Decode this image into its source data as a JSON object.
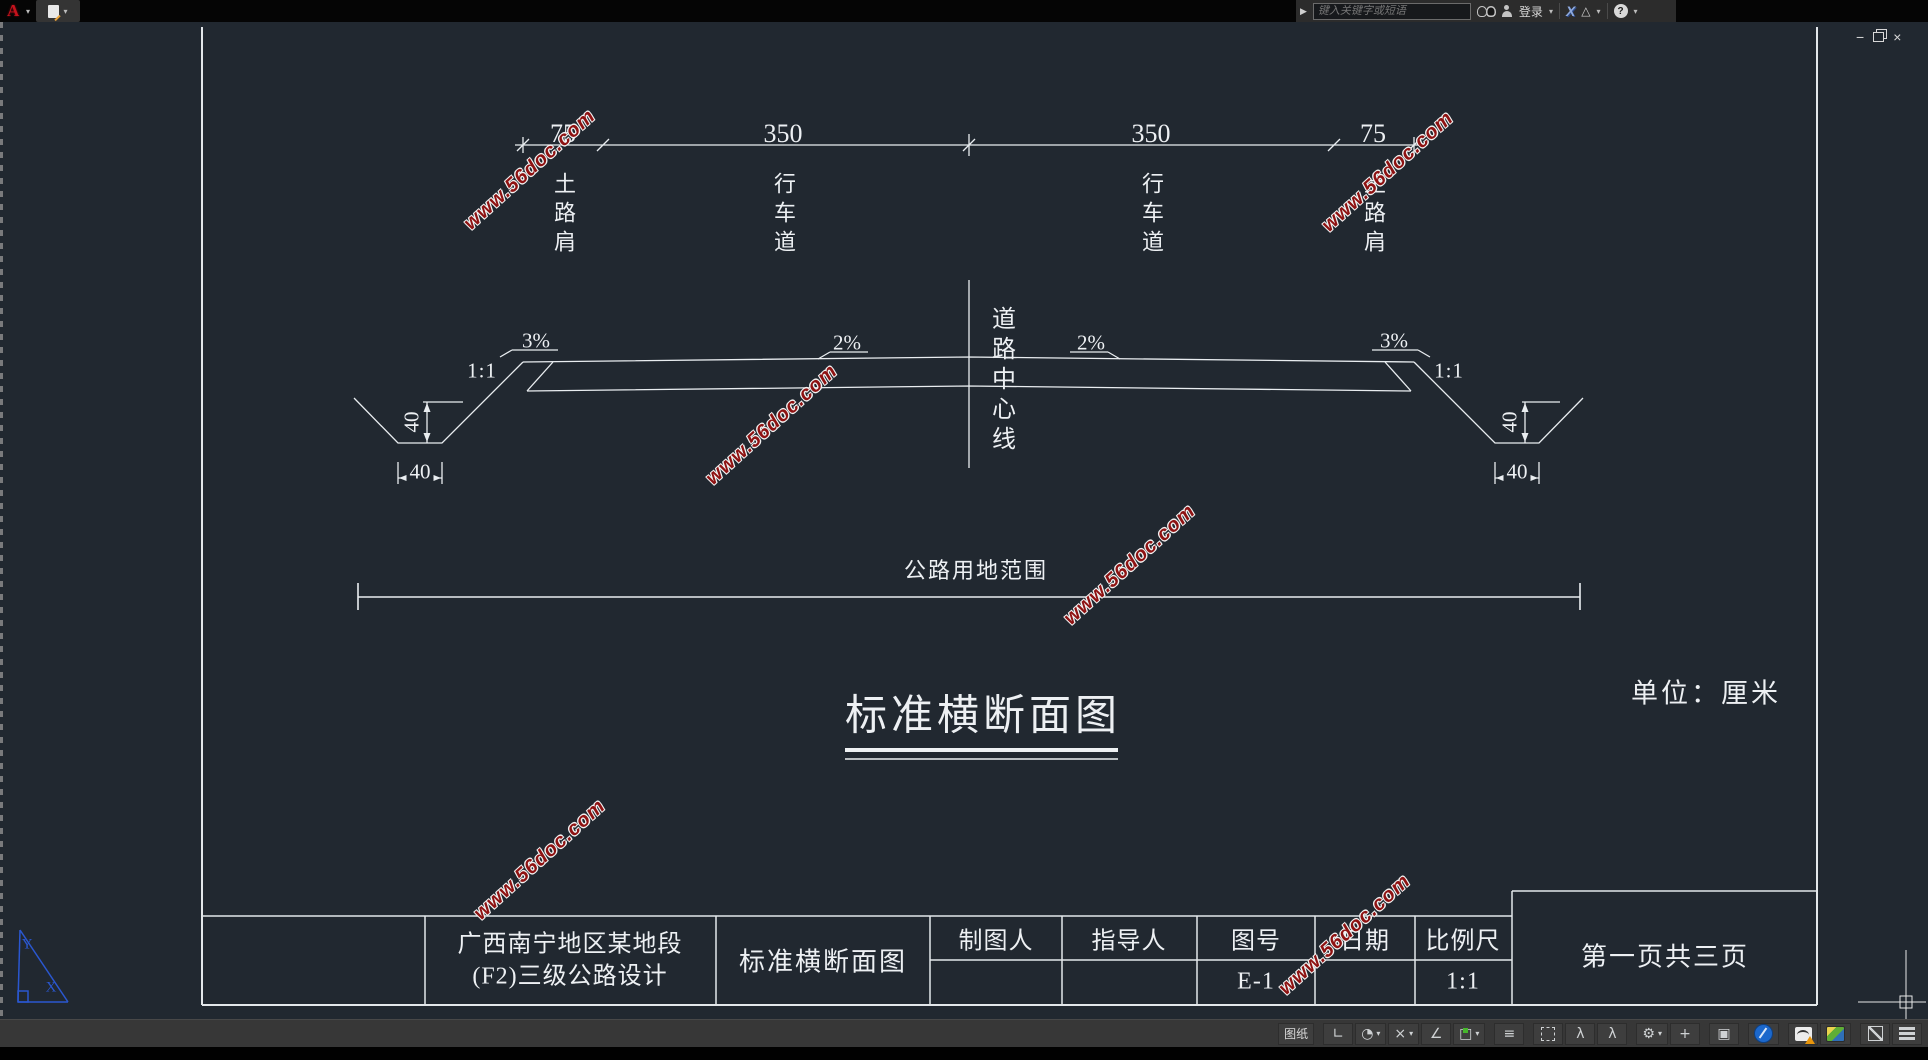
{
  "ui": {
    "dropdown_arrow": "▾"
  },
  "titlebar": {
    "logo": "A",
    "prompt_arrow": "▶",
    "search_placeholder": "键入关键字或短语",
    "signin_label": "登录",
    "exchange_glyph": "X",
    "a360_glyph": "△",
    "help_glyph": "?"
  },
  "doc_window": {
    "minimize": "−",
    "close": "×"
  },
  "drawing": {
    "dim_top": {
      "seg1": "75",
      "seg2": "350",
      "seg3": "350",
      "seg4": "75"
    },
    "lanes": {
      "left_shoulder": "土路肩",
      "left_lane": "行车道",
      "right_lane": "行车道",
      "right_shoulder": "土路肩"
    },
    "centerline_label": "道路中心线",
    "slopes": {
      "left_outer": "3%",
      "left_inner": "2%",
      "right_inner": "2%",
      "right_outer": "3%",
      "left_ratio": "1:1",
      "right_ratio": "1:1"
    },
    "ditch": {
      "left_depth": "40",
      "left_width": "40",
      "right_depth": "40",
      "right_width": "40"
    },
    "extent_label": "公路用地范围",
    "main_title": "标准横断面图",
    "unit_note": "单位：厘米",
    "ucs": {
      "x": "X",
      "y": "Y"
    }
  },
  "title_block": {
    "project_line1": "广西南宁地区某地段",
    "project_line2": "(F2)三级公路设计",
    "drawing_name": "标准横断面图",
    "drafter_label": "制图人",
    "advisor_label": "指导人",
    "sheet_label": "图号",
    "sheet_no": "E-1",
    "date_label": "日期",
    "scale_label": "比例尺",
    "scale_value": "1:1",
    "page_note": "第一页共三页"
  },
  "watermark": {
    "text": "www.56doc.com"
  },
  "statusbar": {
    "paper_label": "图纸",
    "icons": [
      {
        "name": "ortho-icon",
        "glyph": "∟"
      },
      {
        "name": "isodraft-icon",
        "glyph": "◔"
      },
      {
        "name": "snap-icon",
        "glyph": "×"
      },
      {
        "name": "angle-icon",
        "glyph": "∠"
      },
      {
        "name": "osnap-icon",
        "glyph": "□"
      },
      {
        "name": "annotation-lines-icon",
        "glyph": "≡"
      },
      {
        "name": "annotation-visibility-icon",
        "glyph": "λ"
      },
      {
        "name": "annotation-autoscale-icon",
        "glyph": "λ"
      },
      {
        "name": "gear-icon",
        "glyph": "⚙"
      },
      {
        "name": "add-scale-icon",
        "glyph": "+"
      },
      {
        "name": "isolate-objects-icon",
        "glyph": "▣"
      }
    ]
  }
}
